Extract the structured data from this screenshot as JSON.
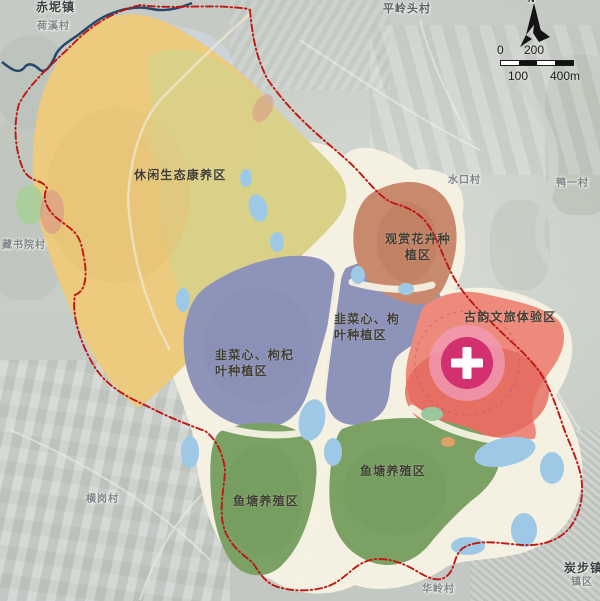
{
  "zones": [
    {
      "id": "leisure-eco-wellness",
      "label": "休闲生态康养区",
      "lines": [
        "休闲生态康养区"
      ]
    },
    {
      "id": "ornamental-flower-planting",
      "label": "观赏花卉种植区",
      "lines": [
        "观赏花卉种",
        "植区"
      ]
    },
    {
      "id": "chive-goji-planting-west",
      "label": "韭菜心、枸杞叶种植区",
      "lines": [
        "韭菜心、枸杞",
        "叶种植区"
      ]
    },
    {
      "id": "chive-goji-planting-east",
      "label": "韭菜心、枸杞叶种植区",
      "lines": [
        "韭菜心、枸",
        "叶种植区"
      ]
    },
    {
      "id": "heritage-culture-tourism",
      "label": "古韵文旅体验区",
      "lines": [
        "古韵文旅体验区"
      ]
    },
    {
      "id": "fishpond-aquaculture-west",
      "label": "鱼塘养殖区",
      "lines": [
        "鱼塘养殖区"
      ]
    },
    {
      "id": "fishpond-aquaculture-east",
      "label": "鱼塘养殖区",
      "lines": [
        "鱼塘养殖区"
      ]
    }
  ],
  "places": [
    {
      "name": "赤坭镇",
      "type": "town"
    },
    {
      "name": "荷溪村",
      "type": "village"
    },
    {
      "name": "平岭头村",
      "type": "village"
    },
    {
      "name": "水口村",
      "type": "village"
    },
    {
      "name": "鸭一村",
      "type": "village"
    },
    {
      "name": "藏书院村",
      "type": "village"
    },
    {
      "name": "横岗村",
      "type": "village"
    },
    {
      "name": "炭步镇",
      "type": "town"
    },
    {
      "name": "镇区",
      "type": "district"
    },
    {
      "name": "华岭村",
      "type": "village"
    }
  ],
  "scalebar": {
    "top": [
      "0",
      "200"
    ],
    "bottom": [
      "100",
      "400m"
    ]
  },
  "north": {
    "label": "N"
  },
  "marker": {
    "symbol": "plus-cross",
    "meaning": "heritage-core"
  },
  "colors": {
    "base": "#f5f1e2",
    "leisure": "#ecca7e",
    "leisure_alt": "#d6d28b",
    "planting": "#8e93b9",
    "flower": "#c8896c",
    "heritage": "#ee8a7c",
    "heritage_deep": "#e4685c",
    "heritage_core": "#d2306e",
    "heritage_ring": "#f09ab4",
    "fishpond": "#7ba164",
    "water": "#9ec9e6",
    "boundary": "#bf1812",
    "river": "#27486b"
  }
}
